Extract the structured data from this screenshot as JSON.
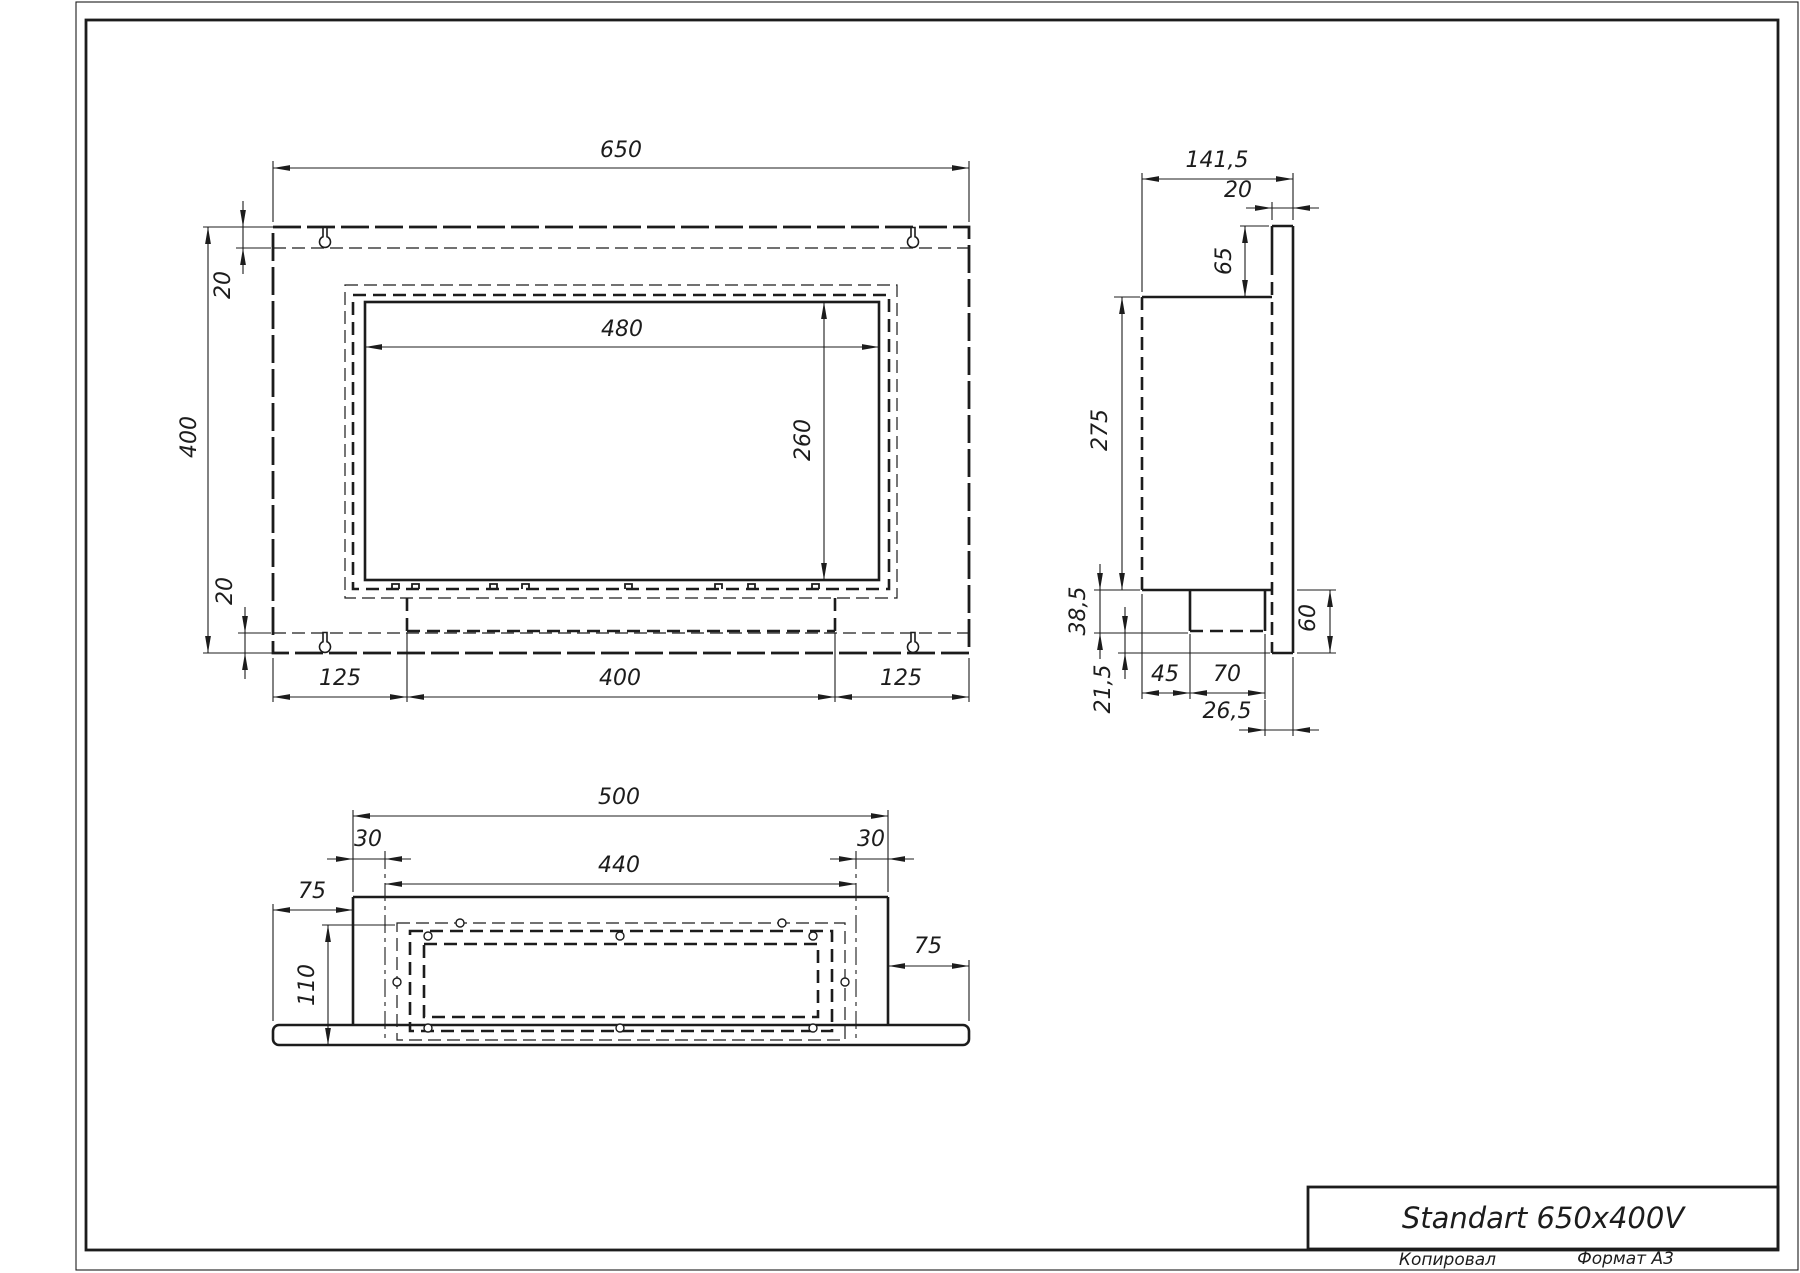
{
  "sheet": {
    "title": "Standart 650x400V",
    "footer_copied": "Копировал",
    "footer_format": "Формат А3",
    "ink_color": "#1c1c1c",
    "paper_color": "#ffffff"
  },
  "drawing": {
    "primitives": [
      {
        "t": "rect",
        "c": "dtl",
        "n": "front-view-outer-plate",
        "x": 273,
        "y": 227,
        "w": 696,
        "h": 426
      },
      {
        "t": "line",
        "c": "dn",
        "n": "front-view-top-fold-line",
        "x1": 273,
        "y1": 248,
        "x2": 969,
        "y2": 248
      },
      {
        "t": "line",
        "c": "dn",
        "n": "front-view-bottom-fold-line",
        "x1": 273,
        "y1": 633,
        "x2": 969,
        "y2": 633
      },
      {
        "t": "key",
        "n": "mounting-keyhole-top-left",
        "cx": 325,
        "cy": 241
      },
      {
        "t": "key",
        "n": "mounting-keyhole-top-right",
        "cx": 913,
        "cy": 241
      },
      {
        "t": "key",
        "n": "mounting-keyhole-bottom-left",
        "cx": 325,
        "cy": 646
      },
      {
        "t": "key",
        "n": "mounting-keyhole-bottom-right",
        "cx": 913,
        "cy": 646
      },
      {
        "t": "rect",
        "c": "dn",
        "n": "front-view-back-panel-hidden",
        "x": 345,
        "y": 285,
        "w": 552,
        "h": 313
      },
      {
        "t": "rect",
        "c": "dt",
        "n": "front-view-body-hidden",
        "x": 353,
        "y": 295,
        "w": 536,
        "h": 294
      },
      {
        "t": "rect",
        "c": "st",
        "n": "front-view-opening",
        "x": 365,
        "y": 302,
        "w": 514,
        "h": 278
      },
      {
        "t": "tab",
        "x": 392,
        "y": 589
      },
      {
        "t": "tab",
        "x": 412,
        "y": 589
      },
      {
        "t": "tab",
        "x": 490,
        "y": 589
      },
      {
        "t": "tab",
        "x": 522,
        "y": 589
      },
      {
        "t": "tab",
        "x": 625,
        "y": 589
      },
      {
        "t": "tab",
        "x": 715,
        "y": 589
      },
      {
        "t": "tab",
        "x": 748,
        "y": 589
      },
      {
        "t": "tab",
        "x": 812,
        "y": 589
      },
      {
        "t": "line",
        "c": "dt",
        "n": "front-view-tray-left",
        "x1": 407,
        "y1": 598,
        "x2": 407,
        "y2": 631
      },
      {
        "t": "line",
        "c": "dt",
        "n": "front-view-tray-right",
        "x1": 835,
        "y1": 598,
        "x2": 835,
        "y2": 631
      },
      {
        "t": "line",
        "c": "dt",
        "n": "front-view-tray-bottom",
        "x1": 407,
        "y1": 631,
        "x2": 835,
        "y2": 631
      },
      {
        "t": "line",
        "c": "st",
        "n": "side-view-plate-top",
        "x1": 1272,
        "y1": 226,
        "x2": 1293,
        "y2": 226
      },
      {
        "t": "line",
        "c": "st",
        "n": "side-view-plate-right",
        "x1": 1293,
        "y1": 226,
        "x2": 1293,
        "y2": 653
      },
      {
        "t": "line",
        "c": "st",
        "n": "side-view-plate-bottom",
        "x1": 1272,
        "y1": 653,
        "x2": 1293,
        "y2": 653
      },
      {
        "t": "line",
        "c": "st",
        "x1": 1272,
        "y1": 226,
        "x2": 1272,
        "y2": 262
      },
      {
        "t": "line",
        "c": "dt",
        "n": "side-view-plate-left-hidden",
        "x1": 1272,
        "y1": 262,
        "x2": 1272,
        "y2": 653
      },
      {
        "t": "line",
        "c": "st",
        "n": "side-view-body-top",
        "x1": 1142,
        "y1": 297,
        "x2": 1272,
        "y2": 297
      },
      {
        "t": "line",
        "c": "dt",
        "n": "side-view-body-left-hidden",
        "x1": 1142,
        "y1": 297,
        "x2": 1142,
        "y2": 590
      },
      {
        "t": "line",
        "c": "st",
        "n": "side-view-body-bottom",
        "x1": 1142,
        "y1": 590,
        "x2": 1272,
        "y2": 590
      },
      {
        "t": "line",
        "c": "st",
        "n": "side-view-tray-left",
        "x1": 1190,
        "y1": 590,
        "x2": 1190,
        "y2": 631
      },
      {
        "t": "line",
        "c": "st",
        "n": "side-view-tray-right",
        "x1": 1265,
        "y1": 590,
        "x2": 1265,
        "y2": 631
      },
      {
        "t": "line",
        "c": "dt",
        "n": "side-view-tray-bottom",
        "x1": 1190,
        "y1": 631,
        "x2": 1265,
        "y2": 631
      },
      {
        "t": "line",
        "c": "st",
        "n": "bottom-view-body-front",
        "x1": 353,
        "y1": 897,
        "x2": 888,
        "y2": 897
      },
      {
        "t": "line",
        "c": "st",
        "n": "bottom-view-body-left",
        "x1": 353,
        "y1": 897,
        "x2": 353,
        "y2": 1025
      },
      {
        "t": "line",
        "c": "st",
        "n": "bottom-view-body-right",
        "x1": 888,
        "y1": 897,
        "x2": 888,
        "y2": 1025
      },
      {
        "t": "rrect",
        "c": "st",
        "n": "bottom-view-plate",
        "x": 273,
        "y": 1025,
        "w": 696,
        "h": 20,
        "r": 6
      },
      {
        "t": "rect",
        "c": "dn",
        "n": "bottom-view-flange-hidden",
        "x": 397,
        "y": 923,
        "w": 448,
        "h": 117
      },
      {
        "t": "rect",
        "c": "dt",
        "n": "bottom-view-burner-outer-hidden",
        "x": 410,
        "y": 931,
        "w": 422,
        "h": 100
      },
      {
        "t": "rect",
        "c": "dt",
        "n": "bottom-view-burner-inner-hidden",
        "x": 424,
        "y": 944,
        "w": 394,
        "h": 73
      },
      {
        "t": "line",
        "c": "dd",
        "n": "bottom-view-burner-edge-left",
        "x1": 385,
        "y1": 851,
        "x2": 385,
        "y2": 1040
      },
      {
        "t": "line",
        "c": "dd",
        "n": "bottom-view-burner-edge-right",
        "x1": 856,
        "y1": 851,
        "x2": 856,
        "y2": 1040
      },
      {
        "t": "hole",
        "cx": 460,
        "cy": 923
      },
      {
        "t": "hole",
        "cx": 782,
        "cy": 923
      },
      {
        "t": "hole",
        "cx": 428,
        "cy": 936
      },
      {
        "t": "hole",
        "cx": 620,
        "cy": 936
      },
      {
        "t": "hole",
        "cx": 813,
        "cy": 936
      },
      {
        "t": "hole",
        "cx": 397,
        "cy": 982
      },
      {
        "t": "hole",
        "cx": 845,
        "cy": 982
      },
      {
        "t": "hole",
        "cx": 428,
        "cy": 1028
      },
      {
        "t": "hole",
        "cx": 620,
        "cy": 1028
      },
      {
        "t": "hole",
        "cx": 813,
        "cy": 1028
      },
      {
        "t": "rect",
        "c": "sn",
        "n": "paper-edge",
        "x": 76,
        "y": 2,
        "w": 1722,
        "h": 1268
      },
      {
        "t": "rect",
        "c": "fr",
        "n": "sheet-frame",
        "x": 86,
        "y": 20,
        "w": 1692,
        "h": 1230
      },
      {
        "t": "rect",
        "c": "fr",
        "n": "title-block-border",
        "x": 1308,
        "y": 1187,
        "w": 470,
        "h": 62
      }
    ],
    "extension_lines": [
      [
        273,
        222,
        273,
        161
      ],
      [
        969,
        222,
        969,
        161
      ],
      [
        203,
        227,
        273,
        227
      ],
      [
        203,
        653,
        273,
        653
      ],
      [
        236,
        248,
        271,
        248
      ],
      [
        238,
        633,
        271,
        633
      ],
      [
        273,
        658,
        273,
        702
      ],
      [
        407,
        633,
        407,
        702
      ],
      [
        835,
        633,
        835,
        702
      ],
      [
        969,
        658,
        969,
        702
      ],
      [
        1142,
        292,
        1142,
        173
      ],
      [
        1293,
        220,
        1293,
        173
      ],
      [
        1272,
        220,
        1272,
        202
      ],
      [
        1240,
        226,
        1269,
        226
      ],
      [
        1114,
        297,
        1140,
        297
      ],
      [
        1094,
        590,
        1140,
        590
      ],
      [
        1094,
        633,
        1188,
        633
      ],
      [
        1118,
        653,
        1270,
        653
      ],
      [
        1142,
        594,
        1142,
        699
      ],
      [
        1190,
        634,
        1190,
        699
      ],
      [
        1265,
        634,
        1265,
        699
      ],
      [
        1265,
        700,
        1265,
        736
      ],
      [
        1293,
        657,
        1293,
        736
      ],
      [
        1297,
        590,
        1336,
        590
      ],
      [
        1297,
        653,
        1336,
        653
      ],
      [
        353,
        892,
        353,
        810
      ],
      [
        888,
        892,
        888,
        810
      ],
      [
        273,
        1021,
        273,
        904
      ],
      [
        969,
        1021,
        969,
        960
      ],
      [
        322,
        925,
        395,
        925
      ]
    ],
    "dimensions": [
      {
        "v": "650",
        "o": "h",
        "a": "in",
        "x1": 273,
        "y1": 168,
        "x2": 969,
        "y2": 168,
        "lx": 621,
        "ly": 157,
        "r": false
      },
      {
        "v": "400",
        "o": "v",
        "a": "in",
        "x1": 208,
        "y1": 227,
        "x2": 208,
        "y2": 653,
        "lx": 196,
        "ly": 437,
        "r": true
      },
      {
        "v": "20",
        "o": "v",
        "a": "out",
        "x1": 243,
        "y1": 227,
        "x2": 243,
        "y2": 248,
        "lx": 230,
        "ly": 285,
        "r": true
      },
      {
        "v": "480",
        "o": "h",
        "a": "in",
        "x1": 365,
        "y1": 347,
        "x2": 879,
        "y2": 347,
        "lx": 622,
        "ly": 336,
        "r": false
      },
      {
        "v": "260",
        "o": "v",
        "a": "in",
        "x1": 824,
        "y1": 302,
        "x2": 824,
        "y2": 580,
        "lx": 810,
        "ly": 440,
        "r": true
      },
      {
        "v": "20",
        "o": "v",
        "a": "out",
        "x1": 245,
        "y1": 633,
        "x2": 245,
        "y2": 653,
        "lx": 232,
        "ly": 591,
        "r": true
      },
      {
        "v": "125",
        "o": "h",
        "a": "in",
        "x1": 273,
        "y1": 697,
        "x2": 407,
        "y2": 697,
        "lx": 340,
        "ly": 685,
        "r": false
      },
      {
        "v": "400",
        "o": "h",
        "a": "in",
        "x1": 407,
        "y1": 697,
        "x2": 835,
        "y2": 697,
        "lx": 620,
        "ly": 685,
        "r": false
      },
      {
        "v": "125",
        "o": "h",
        "a": "in",
        "x1": 835,
        "y1": 697,
        "x2": 969,
        "y2": 697,
        "lx": 901,
        "ly": 685,
        "r": false
      },
      {
        "v": "141,5",
        "o": "h",
        "a": "in",
        "x1": 1142,
        "y1": 179,
        "x2": 1293,
        "y2": 179,
        "lx": 1217,
        "ly": 167,
        "r": false
      },
      {
        "v": "20",
        "o": "h",
        "a": "out",
        "x1": 1272,
        "y1": 208,
        "x2": 1293,
        "y2": 208,
        "lx": 1238,
        "ly": 197,
        "r": false
      },
      {
        "v": "65",
        "o": "v",
        "a": "in",
        "x1": 1245,
        "y1": 226,
        "x2": 1245,
        "y2": 297,
        "lx": 1231,
        "ly": 261,
        "r": true
      },
      {
        "v": "275",
        "o": "v",
        "a": "in",
        "x1": 1122,
        "y1": 297,
        "x2": 1122,
        "y2": 590,
        "lx": 1107,
        "ly": 430,
        "r": true
      },
      {
        "v": "38,5",
        "o": "v",
        "a": "out",
        "x1": 1100,
        "y1": 590,
        "x2": 1100,
        "y2": 633,
        "lx": 1085,
        "ly": 611,
        "r": true
      },
      {
        "v": "21,5",
        "o": "v",
        "a": "out",
        "x1": 1125,
        "y1": 633,
        "x2": 1125,
        "y2": 653,
        "lx": 1110,
        "ly": 689,
        "r": true
      },
      {
        "v": "45",
        "o": "h",
        "a": "in",
        "x1": 1142,
        "y1": 693,
        "x2": 1190,
        "y2": 693,
        "lx": 1165,
        "ly": 681,
        "r": false
      },
      {
        "v": "70",
        "o": "h",
        "a": "in",
        "x1": 1190,
        "y1": 693,
        "x2": 1265,
        "y2": 693,
        "lx": 1227,
        "ly": 681,
        "r": false
      },
      {
        "v": "26,5",
        "o": "h",
        "a": "out",
        "x1": 1265,
        "y1": 730,
        "x2": 1293,
        "y2": 730,
        "lx": 1227,
        "ly": 718,
        "r": false
      },
      {
        "v": "60",
        "o": "v",
        "a": "in",
        "x1": 1330,
        "y1": 590,
        "x2": 1330,
        "y2": 653,
        "lx": 1315,
        "ly": 618,
        "r": true
      },
      {
        "v": "500",
        "o": "h",
        "a": "in",
        "x1": 353,
        "y1": 816,
        "x2": 888,
        "y2": 816,
        "lx": 619,
        "ly": 804,
        "r": false
      },
      {
        "v": "30",
        "o": "h",
        "a": "out",
        "x1": 353,
        "y1": 859,
        "x2": 385,
        "y2": 859,
        "lx": 368,
        "ly": 846,
        "r": false
      },
      {
        "v": "440",
        "o": "h",
        "a": "in",
        "x1": 385,
        "y1": 884,
        "x2": 856,
        "y2": 884,
        "lx": 619,
        "ly": 872,
        "r": false
      },
      {
        "v": "30",
        "o": "h",
        "a": "out",
        "x1": 856,
        "y1": 859,
        "x2": 888,
        "y2": 859,
        "lx": 871,
        "ly": 846,
        "r": false
      },
      {
        "v": "75",
        "o": "h",
        "a": "in",
        "x1": 273,
        "y1": 910,
        "x2": 353,
        "y2": 910,
        "lx": 312,
        "ly": 898,
        "r": false
      },
      {
        "v": "75",
        "o": "h",
        "a": "in",
        "x1": 888,
        "y1": 966,
        "x2": 969,
        "y2": 966,
        "lx": 928,
        "ly": 953,
        "r": false
      },
      {
        "v": "110",
        "o": "v",
        "a": "in",
        "x1": 328,
        "y1": 925,
        "x2": 328,
        "y2": 1045,
        "lx": 314,
        "ly": 985,
        "r": true
      }
    ]
  }
}
